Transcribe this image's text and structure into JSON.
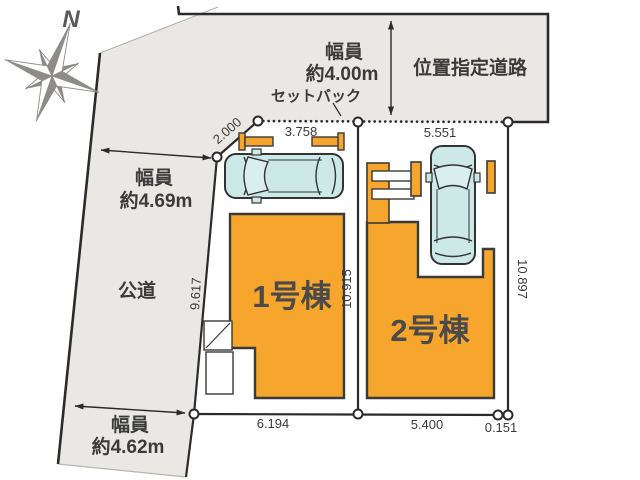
{
  "plan": {
    "north": "N",
    "roads": {
      "top": {
        "name": "位置指定道路",
        "width1": "幅員",
        "width2": "約4.00m",
        "setback": "セットバック"
      },
      "left": {
        "name": "公道",
        "width1": "幅員",
        "width2": "約4.69m"
      },
      "bottom": {
        "width1": "幅員",
        "width2": "約4.62m"
      }
    },
    "lots": [
      {
        "label": "1号棟",
        "dims": {
          "corner": "2.000",
          "top": "3.758",
          "left": "9.617",
          "bottom": "6.194",
          "between": "10.915"
        }
      },
      {
        "label": "2号棟",
        "dims": {
          "top": "5.551",
          "right": "10.897",
          "bottom": "5.400",
          "offset": "0.151"
        }
      }
    ],
    "colors": {
      "building_orange": "#F6A52D",
      "road_gray": "#EAE8E5",
      "car_cyan": "#CCE8E7",
      "line_dark": "#2B2B2B",
      "compass_gray": "#8E8C89"
    }
  }
}
